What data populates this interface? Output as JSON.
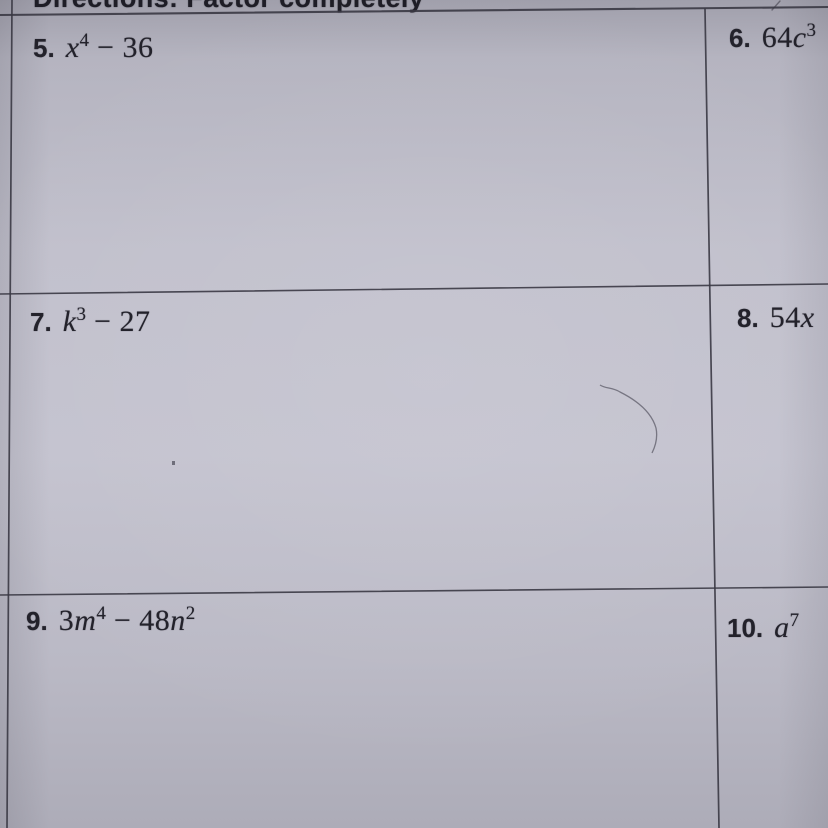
{
  "page": {
    "type": "photographed math worksheet",
    "directions": "Directions: Factor completely"
  },
  "problems": [
    {
      "number": "5.",
      "expression": "x⁴ − 36",
      "parts": [
        {
          "k": "var",
          "v": "x"
        },
        {
          "k": "sup",
          "v": "4"
        },
        {
          "k": "op",
          "v": " − "
        },
        {
          "k": "num",
          "v": "36"
        }
      ]
    },
    {
      "number": "6.",
      "expression": "64c³",
      "parts": [
        {
          "k": "num",
          "v": "64"
        },
        {
          "k": "var",
          "v": "c"
        },
        {
          "k": "sup",
          "v": "3"
        }
      ]
    },
    {
      "number": "7.",
      "expression": "k³ − 27",
      "parts": [
        {
          "k": "var",
          "v": "k"
        },
        {
          "k": "sup",
          "v": "3"
        },
        {
          "k": "op",
          "v": " − "
        },
        {
          "k": "num",
          "v": "27"
        }
      ]
    },
    {
      "number": "8.",
      "expression": "54x",
      "parts": [
        {
          "k": "num",
          "v": "54"
        },
        {
          "k": "var",
          "v": "x"
        }
      ]
    },
    {
      "number": "9.",
      "expression": "3m⁴ − 48n²",
      "parts": [
        {
          "k": "num",
          "v": "3"
        },
        {
          "k": "var",
          "v": "m"
        },
        {
          "k": "sup",
          "v": "4"
        },
        {
          "k": "op",
          "v": " − "
        },
        {
          "k": "num",
          "v": "48"
        },
        {
          "k": "var",
          "v": "n"
        },
        {
          "k": "sup",
          "v": "2"
        }
      ]
    },
    {
      "number": "10.",
      "expression": "a⁷",
      "parts": [
        {
          "k": "var",
          "v": "a"
        },
        {
          "k": "sup",
          "v": "7"
        }
      ]
    }
  ],
  "colors": {
    "paper": "#c1c0cc",
    "paper_edge": "#a09fab",
    "ink": "#23222b",
    "grid_line": "#3a3944"
  }
}
